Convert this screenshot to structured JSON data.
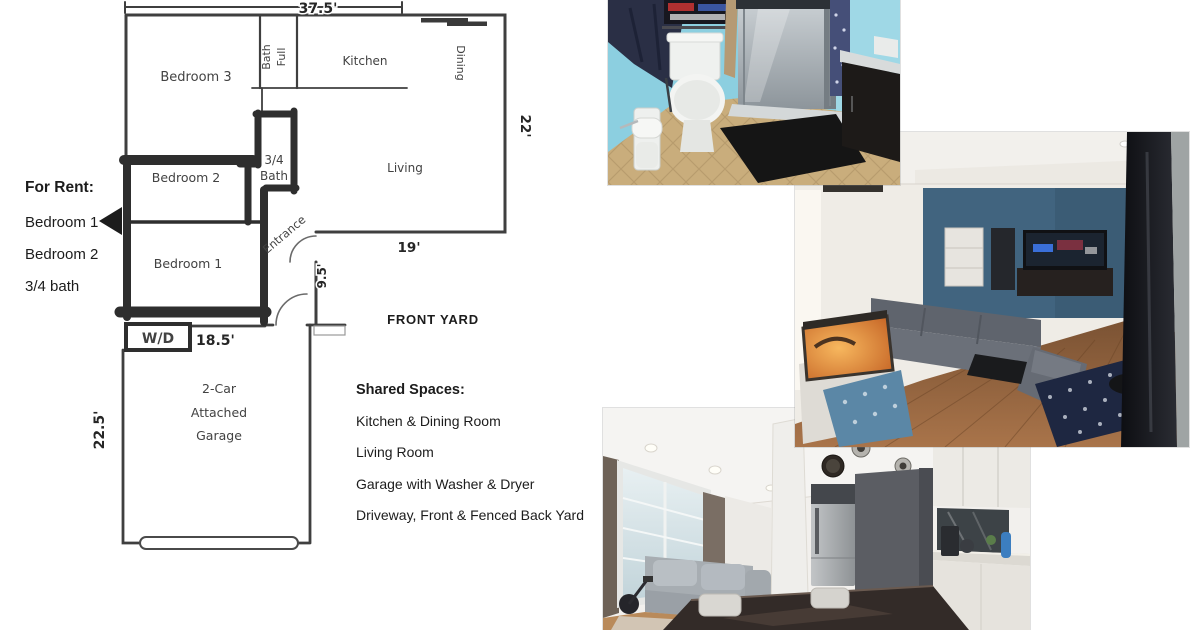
{
  "floor_plan": {
    "labels": {
      "bedroom3": "Bedroom 3",
      "full_bath": [
        "Full",
        "Bath"
      ],
      "kitchen": "Kitchen",
      "dining": "Dining",
      "living": "Living",
      "three_quarter_bath": [
        "3/4",
        "Bath"
      ],
      "bedroom2": "Bedroom 2",
      "bedroom1": "Bedroom 1",
      "entrance": "Entrance",
      "washer_dryer": "W/D",
      "garage": [
        "2-Car",
        "Attached",
        "Garage"
      ],
      "front_yard": "FRONT YARD"
    },
    "dimensions": {
      "top_width": "37.5'",
      "right_height": "22'",
      "living_width": "19'",
      "entrance_depth": "9.5'",
      "garage_width": "18.5'",
      "garage_depth": "22.5'"
    }
  },
  "for_rent": {
    "heading": "For Rent:",
    "items": [
      "Bedroom 1",
      "Bedroom 2",
      "3/4 bath"
    ]
  },
  "shared_spaces": {
    "heading": "Shared Spaces:",
    "items": [
      "Kitchen & Dining Room",
      "Living Room",
      "Garage with Washer & Dryer",
      "Driveway, Front & Fenced Back Yard"
    ]
  },
  "photos": [
    {
      "id": "bathroom"
    },
    {
      "id": "living-room"
    },
    {
      "id": "kitchen-dining"
    }
  ],
  "colors": {
    "plan_ink": "#3f3f3f",
    "plan_thick_ink": "#2e2e2e",
    "bathroom_wall_blue": "#8ccfe0",
    "tile_floor_tan": "#c9ad7c",
    "living_accent_blue": "#41647f",
    "wood_floor_brown": "#8a5f3e",
    "curtain_dark": "#17181d",
    "kitchen_accent_gray": "#5b5d63"
  }
}
